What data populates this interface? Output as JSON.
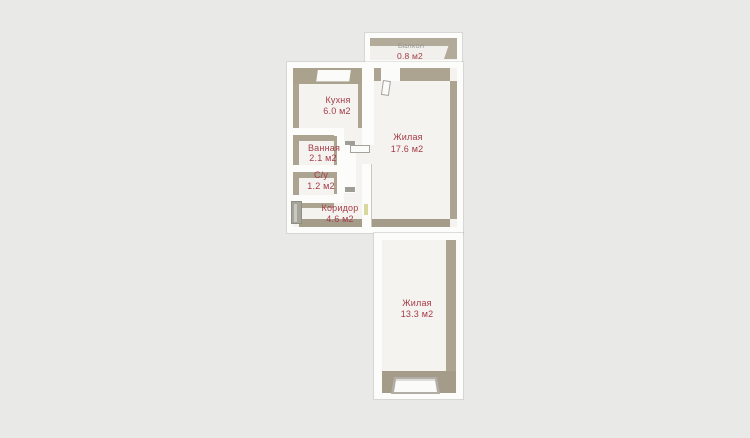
{
  "title": "Apartment floor plan",
  "colors": {
    "background": "#e9e9e8",
    "wall_white": "#fcfcfb",
    "wall_face_beige": "#aca490",
    "floor": "#f4f3f0",
    "room_label": "#a53c47",
    "muted_label": "#9b9994",
    "entry_door": "#a4a49a",
    "door_marker": "#d8d79c"
  },
  "floorplan": {
    "rooms": [
      {
        "id": "balcony",
        "name": "Балкон",
        "area": "0.8 м2"
      },
      {
        "id": "kitchen",
        "name": "Кухня",
        "area": "6.0 м2"
      },
      {
        "id": "bathroom",
        "name": "Ванная",
        "area": "2.1 м2"
      },
      {
        "id": "wc",
        "name": "С/у",
        "area": "1.2 м2"
      },
      {
        "id": "corridor",
        "name": "Коридор",
        "area": "4.6 м2"
      },
      {
        "id": "living_1",
        "name": "Жилая",
        "area": "17.6 м2"
      },
      {
        "id": "living_2",
        "name": "Жилая",
        "area": "13.3 м2"
      }
    ]
  }
}
